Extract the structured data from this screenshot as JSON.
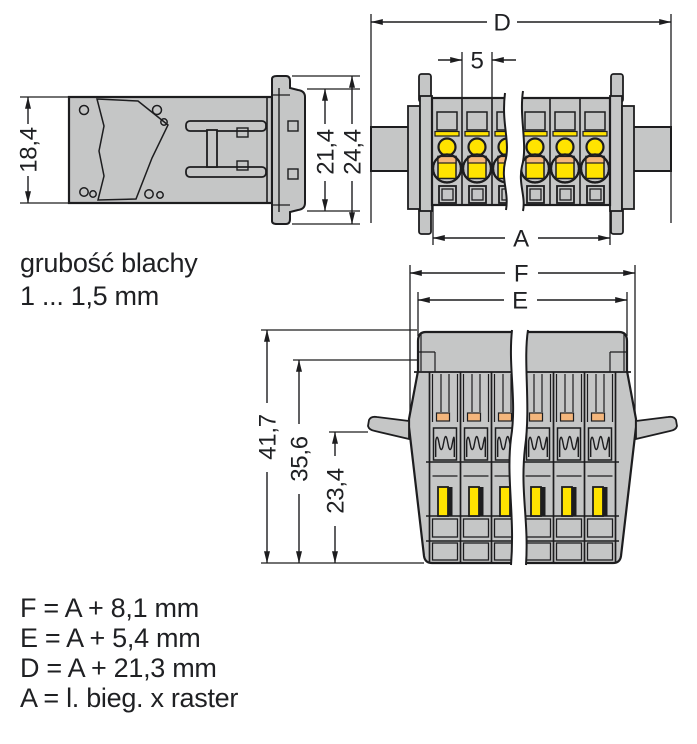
{
  "diagram": {
    "side_view": {
      "label_height": "18,4",
      "label_flange_inner": "21,4",
      "label_flange_outer": "24,4"
    },
    "sheet_note": {
      "line1": "grubość blachy",
      "line2": "1 ... 1,5 mm"
    },
    "front_view": {
      "label_total_width": "D",
      "label_pitch": "5",
      "label_pole_width": "A"
    },
    "bottom_view": {
      "label_width_f": "F",
      "label_width_e": "E",
      "label_depth_total": "41,7",
      "label_depth_housing": "35,6",
      "label_depth_lever": "23,4"
    },
    "formulas": [
      "F = A + 8,1 mm",
      "E = A + 5,4 mm",
      "D = A + 21,3 mm",
      "A = l. bieg. x raster"
    ],
    "colors": {
      "housing_gray": "#c5c6c6",
      "contact_yellow": "#ffe300",
      "marker_orange": "#f4b67c",
      "line": "#1d1d1f",
      "background": "#ffffff"
    }
  }
}
